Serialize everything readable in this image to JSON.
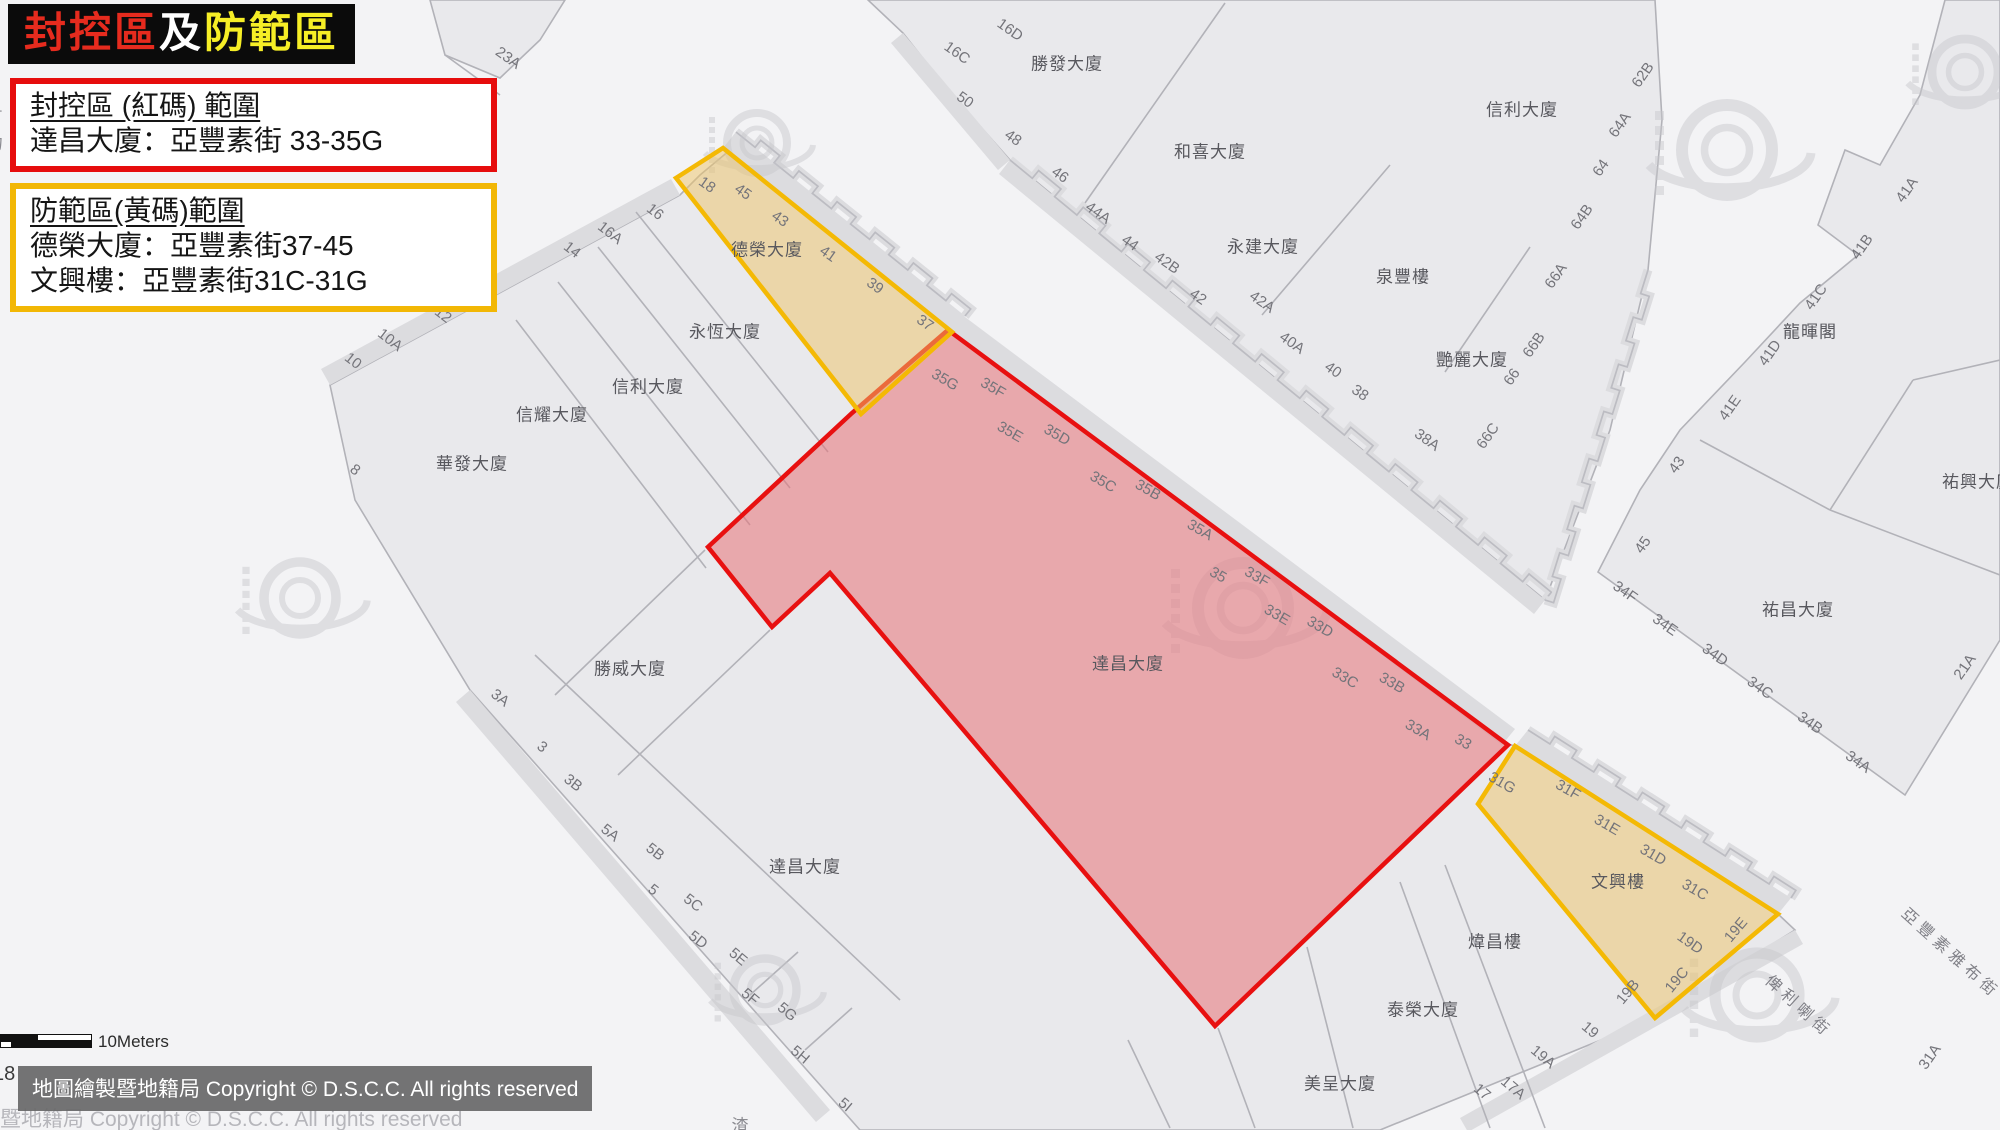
{
  "title_banner": {
    "parts": [
      {
        "text": "封控區",
        "color": "#e62b1e"
      },
      {
        "text": "及",
        "color": "#ffffff"
      },
      {
        "text": "防範區",
        "color": "#f6ee26"
      }
    ]
  },
  "legend_red": {
    "heading": "封控區 (紅碼) 範圍",
    "line1": "達昌大廈：亞豐素街 33-35G",
    "border_color": "#e60d0d"
  },
  "legend_yellow": {
    "heading": "防範區(黃碼)範圍",
    "line1": "德榮大廈：亞豐素街37-45",
    "line2": "文興樓：亞豐素街31C-31G",
    "border_color": "#f2b705"
  },
  "scale_bar": {
    "label": "10Meters"
  },
  "copyright": {
    "overlay_text": "地圖繪製暨地籍局 Copyright © D.S.C.C. All rights reserved",
    "ghost_text": "暨地籍局 Copyright © D.S.C.C. All rights reserved",
    "edge_number": "18"
  },
  "map": {
    "colors": {
      "street": "#f3f3f5",
      "block_fill": "#e9e9ec",
      "block_stroke": "#b2b2b8",
      "shadow": "#dcdcdf",
      "steps_stroke": "#bcbcc2",
      "red_zone_fill": "rgba(231,115,121,0.55)",
      "red_zone_stroke": "#e81010",
      "yellow_zone_fill": "rgba(238,196,102,0.5)",
      "yellow_zone_stroke": "#f4b904",
      "watermark": "#c6c6cb"
    },
    "zones": [
      {
        "name": "red-zone-polygon",
        "kind": "red",
        "points": "948,330 852,413 708,547 772,627 830,573 1215,1026 1508,745"
      },
      {
        "name": "yellow-zone-polygon-1",
        "kind": "yellow",
        "points": "676,178 723,148 952,332 861,414"
      },
      {
        "name": "yellow-zone-polygon-2",
        "kind": "yellow",
        "points": "1515,746 1778,914 1655,1018 1478,804"
      }
    ],
    "blocks": [
      "868,0 1655,0 1662,120 1648,270 1610,430 1545,600 1010,160 948,90 903,33",
      "1945,0 2000,0 2000,640 1905,795 1598,572 1640,490 1680,430 1745,362 1800,303 1858,255 1818,225 1845,150 1880,165 1920,95",
      "700,175 730,150 950,330 1500,742 1515,746 1778,914 1795,930 1650,1020 1380,1130 860,1130 470,690 355,500 330,385 680,195",
      "430,0 565,0 540,40 500,78 445,55"
    ],
    "shadows": [
      "723,148 952,332 965,316 736,132",
      "948,330 1502,745 1515,729 961,314",
      "1515,746 1778,914 1791,898 1528,730",
      "1010,160 1545,600 1534,614 999,174",
      "680,195 330,385 321,369 671,179",
      "470,690 830,1110 816,1122 456,702",
      "1795,930 1460,1118 1468,1132 1803,944",
      "903,33 1010,160 998,170 891,43"
    ],
    "parcel_lines": [
      [
        1225,
        3,
        1085,
        203
      ],
      [
        1390,
        165,
        1262,
        315
      ],
      [
        1530,
        247,
        1445,
        372
      ],
      [
        1700,
        440,
        1830,
        510
      ],
      [
        1830,
        510,
        2000,
        575
      ],
      [
        1830,
        510,
        1913,
        380
      ],
      [
        1913,
        380,
        2000,
        360
      ],
      [
        636,
        212,
        828,
        452
      ],
      [
        598,
        247,
        790,
        488
      ],
      [
        558,
        282,
        750,
        525
      ],
      [
        516,
        320,
        706,
        568
      ],
      [
        705,
        550,
        555,
        695
      ],
      [
        770,
        630,
        618,
        775
      ],
      [
        535,
        655,
        900,
        1000
      ],
      [
        1307,
        947,
        1353,
        1128
      ],
      [
        1400,
        882,
        1490,
        1128
      ],
      [
        1445,
        865,
        1545,
        1128
      ],
      [
        1218,
        1028,
        1255,
        1128
      ],
      [
        1128,
        1040,
        1170,
        1128
      ],
      [
        445,
        55,
        500,
        95
      ],
      [
        805,
        1050,
        852,
        1008
      ],
      [
        750,
        995,
        798,
        952
      ]
    ],
    "stepped_edges": [
      {
        "from": [
          1010,
          160
        ],
        "to": [
          1545,
          600
        ],
        "n": 12,
        "jog": 10
      },
      {
        "from": [
          736,
          132
        ],
        "to": [
          965,
          316
        ],
        "n": 6,
        "jog": 9
      },
      {
        "from": [
          1528,
          730
        ],
        "to": [
          1791,
          898
        ],
        "n": 6,
        "jog": 9
      },
      {
        "from": [
          1648,
          270
        ],
        "to": [
          1545,
          600
        ],
        "n": 7,
        "jog": 9
      }
    ],
    "watermarks": [
      [
        1243,
        608,
        1.5
      ],
      [
        1727,
        150,
        1.5
      ],
      [
        757,
        143,
        1.0
      ],
      [
        1757,
        995,
        1.4
      ],
      [
        300,
        598,
        1.2
      ],
      [
        765,
        990,
        1.05
      ],
      [
        1965,
        72,
        1.1
      ]
    ],
    "building_labels": [
      {
        "text": "勝發大廈",
        "x": 1067,
        "y": 62
      },
      {
        "text": "和喜大廈",
        "x": 1210,
        "y": 150
      },
      {
        "text": "永建大廈",
        "x": 1263,
        "y": 245
      },
      {
        "text": "泉豐樓",
        "x": 1403,
        "y": 275
      },
      {
        "text": "艷麗大廈",
        "x": 1472,
        "y": 358
      },
      {
        "text": "信利大廈",
        "x": 1522,
        "y": 108
      },
      {
        "text": "龍暉閣",
        "x": 1810,
        "y": 330
      },
      {
        "text": "祐興大廈",
        "x": 1978,
        "y": 480
      },
      {
        "text": "祐昌大廈",
        "x": 1798,
        "y": 608
      },
      {
        "text": "永恆大廈",
        "x": 725,
        "y": 330
      },
      {
        "text": "信利大廈",
        "x": 648,
        "y": 385
      },
      {
        "text": "信耀大廈",
        "x": 552,
        "y": 413
      },
      {
        "text": "華發大廈",
        "x": 472,
        "y": 462
      },
      {
        "text": "勝威大廈",
        "x": 630,
        "y": 667
      },
      {
        "text": "達昌大廈",
        "x": 805,
        "y": 865
      },
      {
        "text": "達昌大廈",
        "x": 1128,
        "y": 662
      },
      {
        "text": "德榮大廈",
        "x": 767,
        "y": 248
      },
      {
        "text": "文興樓",
        "x": 1618,
        "y": 880
      },
      {
        "text": "煒昌樓",
        "x": 1495,
        "y": 940
      },
      {
        "text": "泰榮大廈",
        "x": 1423,
        "y": 1008
      },
      {
        "text": "美呈大廈",
        "x": 1340,
        "y": 1082
      }
    ],
    "number_labels": [
      {
        "text": "23A",
        "x": 508,
        "y": 58,
        "rot": 35
      },
      {
        "text": "16C",
        "x": 957,
        "y": 53,
        "rot": 35
      },
      {
        "text": "16D",
        "x": 1010,
        "y": 30,
        "rot": 35
      },
      {
        "text": "50",
        "x": 965,
        "y": 100,
        "rot": 35
      },
      {
        "text": "48",
        "x": 1013,
        "y": 138,
        "rot": 35
      },
      {
        "text": "46",
        "x": 1060,
        "y": 175,
        "rot": 35
      },
      {
        "text": "44A",
        "x": 1098,
        "y": 213,
        "rot": 35
      },
      {
        "text": "44",
        "x": 1130,
        "y": 243,
        "rot": 35
      },
      {
        "text": "42B",
        "x": 1167,
        "y": 263,
        "rot": 35
      },
      {
        "text": "42",
        "x": 1198,
        "y": 297,
        "rot": 35
      },
      {
        "text": "42A",
        "x": 1262,
        "y": 302,
        "rot": 35
      },
      {
        "text": "40A",
        "x": 1292,
        "y": 343,
        "rot": 35
      },
      {
        "text": "40",
        "x": 1333,
        "y": 370,
        "rot": 35
      },
      {
        "text": "38",
        "x": 1360,
        "y": 393,
        "rot": 35
      },
      {
        "text": "38A",
        "x": 1427,
        "y": 440,
        "rot": 35
      },
      {
        "text": "66C",
        "x": 1488,
        "y": 436,
        "rot": -55
      },
      {
        "text": "66",
        "x": 1512,
        "y": 377,
        "rot": -55
      },
      {
        "text": "66B",
        "x": 1534,
        "y": 345,
        "rot": -55
      },
      {
        "text": "66A",
        "x": 1556,
        "y": 276,
        "rot": -55
      },
      {
        "text": "64B",
        "x": 1582,
        "y": 217,
        "rot": -55
      },
      {
        "text": "64",
        "x": 1601,
        "y": 168,
        "rot": -55
      },
      {
        "text": "64A",
        "x": 1620,
        "y": 125,
        "rot": -55
      },
      {
        "text": "62B",
        "x": 1643,
        "y": 75,
        "rot": -55
      },
      {
        "text": "41A",
        "x": 1907,
        "y": 190,
        "rot": -55
      },
      {
        "text": "41B",
        "x": 1862,
        "y": 247,
        "rot": -55
      },
      {
        "text": "41C",
        "x": 1816,
        "y": 297,
        "rot": -55
      },
      {
        "text": "41D",
        "x": 1770,
        "y": 353,
        "rot": -55
      },
      {
        "text": "41E",
        "x": 1730,
        "y": 408,
        "rot": -55
      },
      {
        "text": "43",
        "x": 1677,
        "y": 465,
        "rot": -55
      },
      {
        "text": "45",
        "x": 1643,
        "y": 545,
        "rot": -55
      },
      {
        "text": "34F",
        "x": 1625,
        "y": 592,
        "rot": 35
      },
      {
        "text": "34E",
        "x": 1665,
        "y": 625,
        "rot": 35
      },
      {
        "text": "34D",
        "x": 1715,
        "y": 655,
        "rot": 35
      },
      {
        "text": "34C",
        "x": 1760,
        "y": 688,
        "rot": 35
      },
      {
        "text": "34B",
        "x": 1810,
        "y": 723,
        "rot": 35
      },
      {
        "text": "34A",
        "x": 1858,
        "y": 762,
        "rot": 35
      },
      {
        "text": "21A",
        "x": 1965,
        "y": 667,
        "rot": -55
      },
      {
        "text": "31A",
        "x": 1930,
        "y": 1057,
        "rot": -55
      },
      {
        "text": "16",
        "x": 655,
        "y": 212,
        "rot": 38
      },
      {
        "text": "16A",
        "x": 610,
        "y": 233,
        "rot": 38
      },
      {
        "text": "14",
        "x": 572,
        "y": 250,
        "rot": 38
      },
      {
        "text": "12",
        "x": 443,
        "y": 315,
        "rot": 38
      },
      {
        "text": "10A",
        "x": 390,
        "y": 340,
        "rot": 38
      },
      {
        "text": "10",
        "x": 353,
        "y": 361,
        "rot": 38
      },
      {
        "text": "8",
        "x": 355,
        "y": 470,
        "rot": 38
      },
      {
        "text": "3A",
        "x": 500,
        "y": 698,
        "rot": 38
      },
      {
        "text": "3",
        "x": 542,
        "y": 747,
        "rot": 38
      },
      {
        "text": "3B",
        "x": 573,
        "y": 783,
        "rot": 38
      },
      {
        "text": "5A",
        "x": 610,
        "y": 833,
        "rot": 38
      },
      {
        "text": "5B",
        "x": 655,
        "y": 852,
        "rot": 38
      },
      {
        "text": "5",
        "x": 653,
        "y": 890,
        "rot": 38
      },
      {
        "text": "5C",
        "x": 693,
        "y": 903,
        "rot": 38
      },
      {
        "text": "5D",
        "x": 698,
        "y": 940,
        "rot": 38
      },
      {
        "text": "5E",
        "x": 738,
        "y": 957,
        "rot": 40
      },
      {
        "text": "5F",
        "x": 750,
        "y": 997,
        "rot": 40
      },
      {
        "text": "5G",
        "x": 787,
        "y": 1012,
        "rot": 40
      },
      {
        "text": "5H",
        "x": 800,
        "y": 1055,
        "rot": 40
      },
      {
        "text": "5I",
        "x": 845,
        "y": 1105,
        "rot": 40
      },
      {
        "text": "17",
        "x": 1482,
        "y": 1092,
        "rot": 40
      },
      {
        "text": "17A",
        "x": 1513,
        "y": 1088,
        "rot": 40
      },
      {
        "text": "19A",
        "x": 1543,
        "y": 1057,
        "rot": 40
      },
      {
        "text": "19",
        "x": 1590,
        "y": 1030,
        "rot": 40
      },
      {
        "text": "18",
        "x": 707,
        "y": 185,
        "rot": 35
      },
      {
        "text": "45",
        "x": 743,
        "y": 192,
        "rot": 35
      },
      {
        "text": "43",
        "x": 780,
        "y": 219,
        "rot": 35
      },
      {
        "text": "41",
        "x": 828,
        "y": 254,
        "rot": 35
      },
      {
        "text": "39",
        "x": 875,
        "y": 286,
        "rot": 35
      },
      {
        "text": "37",
        "x": 925,
        "y": 323,
        "rot": 35
      },
      {
        "text": "35G",
        "x": 945,
        "y": 380,
        "rot": 30
      },
      {
        "text": "35F",
        "x": 993,
        "y": 388,
        "rot": 30
      },
      {
        "text": "35E",
        "x": 1010,
        "y": 432,
        "rot": 30
      },
      {
        "text": "35D",
        "x": 1057,
        "y": 435,
        "rot": 30
      },
      {
        "text": "35C",
        "x": 1103,
        "y": 482,
        "rot": 30
      },
      {
        "text": "35B",
        "x": 1148,
        "y": 490,
        "rot": 30
      },
      {
        "text": "35A",
        "x": 1200,
        "y": 530,
        "rot": 30
      },
      {
        "text": "35",
        "x": 1218,
        "y": 575,
        "rot": 30
      },
      {
        "text": "33F",
        "x": 1257,
        "y": 577,
        "rot": 30
      },
      {
        "text": "33E",
        "x": 1277,
        "y": 615,
        "rot": 30
      },
      {
        "text": "33D",
        "x": 1320,
        "y": 627,
        "rot": 30
      },
      {
        "text": "33C",
        "x": 1345,
        "y": 678,
        "rot": 30
      },
      {
        "text": "33B",
        "x": 1392,
        "y": 683,
        "rot": 30
      },
      {
        "text": "33A",
        "x": 1418,
        "y": 730,
        "rot": 30
      },
      {
        "text": "33",
        "x": 1463,
        "y": 742,
        "rot": 30
      },
      {
        "text": "31G",
        "x": 1502,
        "y": 783,
        "rot": 30
      },
      {
        "text": "31F",
        "x": 1568,
        "y": 790,
        "rot": 30
      },
      {
        "text": "31E",
        "x": 1607,
        "y": 825,
        "rot": 30
      },
      {
        "text": "31D",
        "x": 1653,
        "y": 855,
        "rot": 30
      },
      {
        "text": "31C",
        "x": 1695,
        "y": 890,
        "rot": 30
      },
      {
        "text": "19D",
        "x": 1690,
        "y": 943,
        "rot": 35
      },
      {
        "text": "19E",
        "x": 1736,
        "y": 930,
        "rot": -50
      },
      {
        "text": "19B",
        "x": 1628,
        "y": 992,
        "rot": -50
      },
      {
        "text": "19C",
        "x": 1677,
        "y": 980,
        "rot": -50
      }
    ],
    "street_labels": [
      {
        "text": "亞豐素雅布街",
        "x": 1952,
        "y": 952,
        "rot": 42
      },
      {
        "text": "俾利喇街",
        "x": 1800,
        "y": 1005,
        "rot": 42
      }
    ],
    "fragments": [
      {
        "text": "言",
        "x": -6,
        "y": 115
      },
      {
        "text": "物",
        "x": -6,
        "y": 142
      },
      {
        "text": "渣",
        "x": 740,
        "y": 1124
      }
    ]
  }
}
